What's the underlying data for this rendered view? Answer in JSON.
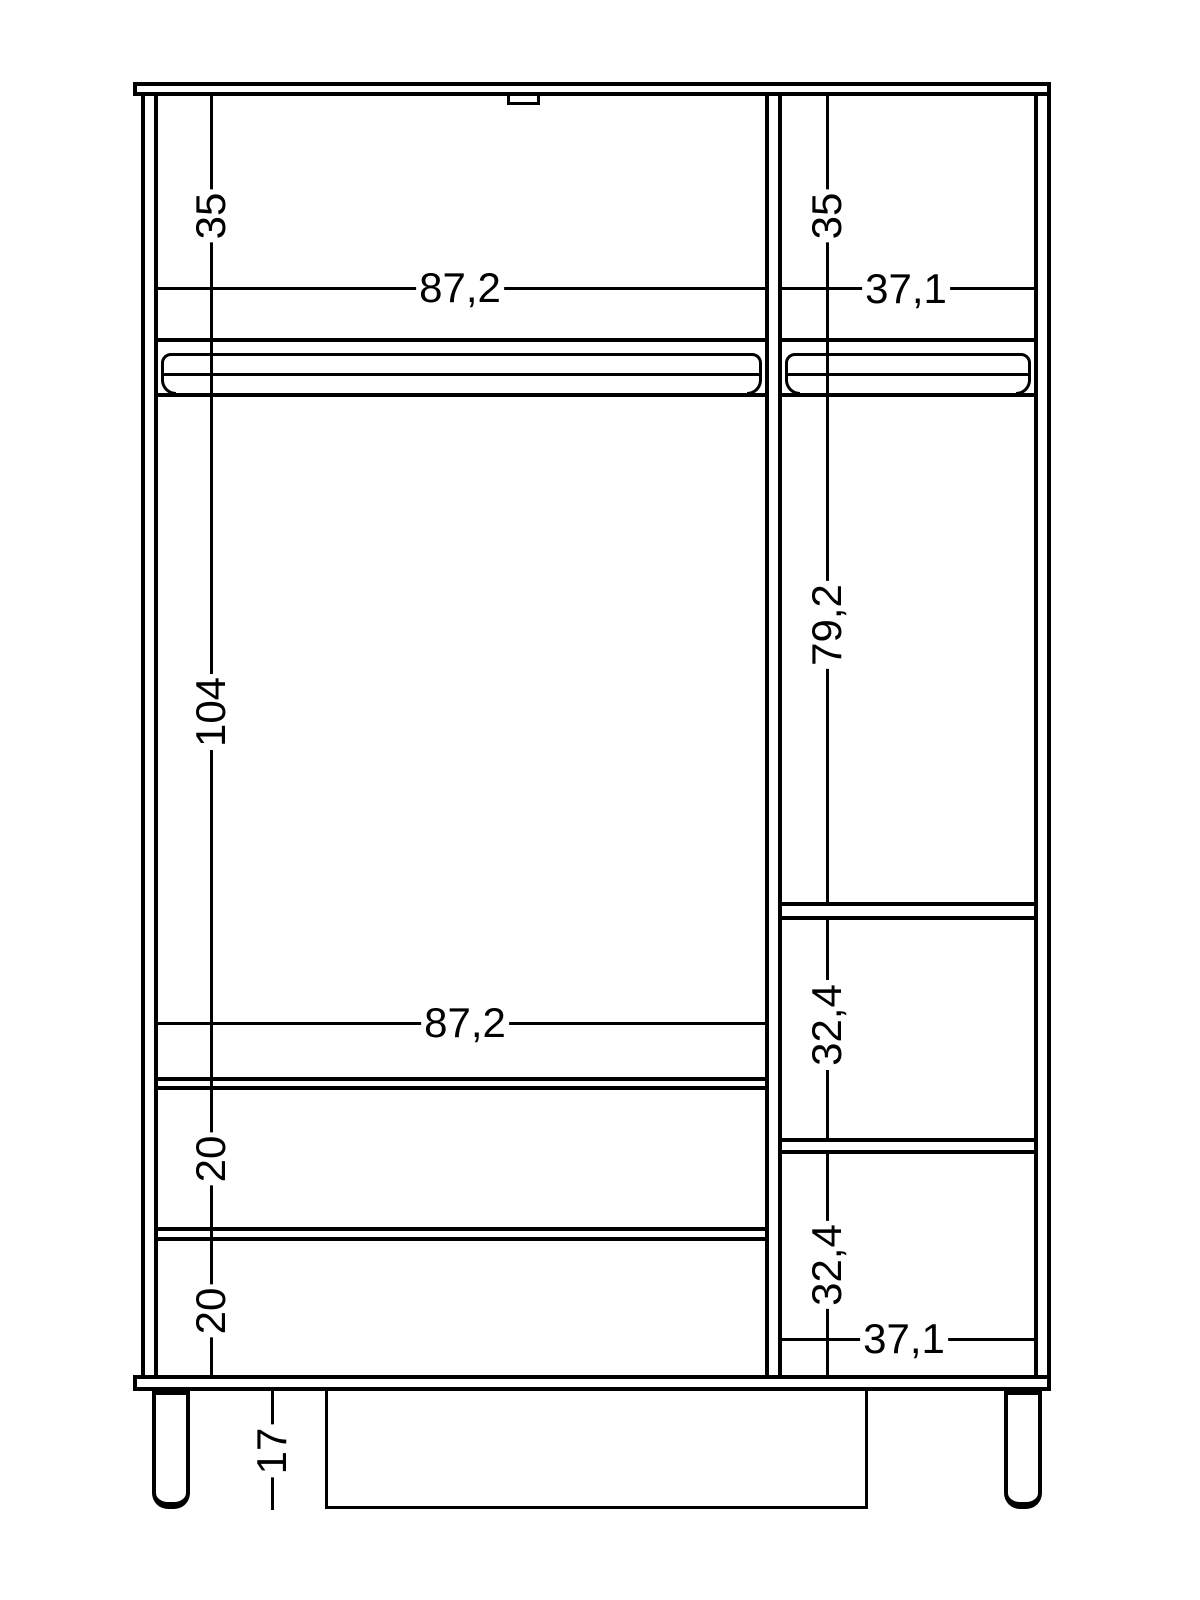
{
  "page": {
    "background": "#ffffff",
    "line_color": "#000000"
  },
  "diagram": {
    "type": "furniture-front-elevation-dimension-drawing",
    "object": "wardrobe-with-drawers-and-side-shelves",
    "decimal_style": "comma",
    "dim_labels": {
      "top_left_compartment_height": "35",
      "top_right_compartment_height": "35",
      "left_compartment_width_top": "87,2",
      "right_compartment_width_top": "37,1",
      "left_hanging_space_height": "104",
      "right_hanging_space_height": "79,2",
      "right_cubby_1_height": "32,4",
      "right_cubby_2_height": "32,4",
      "drawer_1_height": "20",
      "drawer_2_height": "20",
      "left_compartment_width_bottom": "87,2",
      "right_compartment_width_bottom": "37,1",
      "leg_height": "17"
    }
  }
}
